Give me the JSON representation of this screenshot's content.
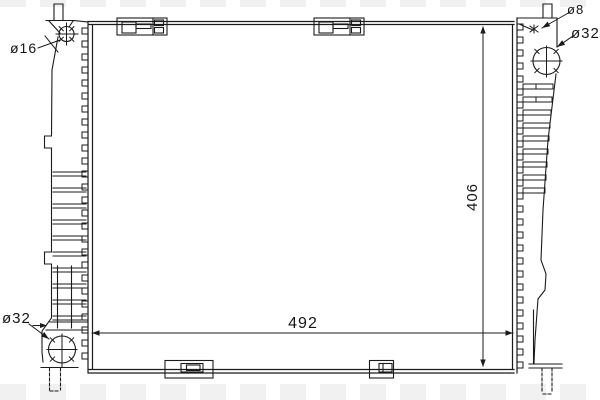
{
  "drawing": {
    "type": "technical-line-drawing",
    "subject": "radiator-front-view",
    "colors": {
      "line": "#1b1b1b",
      "background": "#ffffff",
      "watermark_stripe": "#f1f1f1"
    },
    "labels": {
      "filler_neck_diameter": "ø16",
      "bleed_screw_diameter": "ø8",
      "inlet_pipe_diameter": "ø32",
      "outlet_pipe_diameter": "ø32",
      "core_height": "406",
      "core_width": "492"
    }
  }
}
